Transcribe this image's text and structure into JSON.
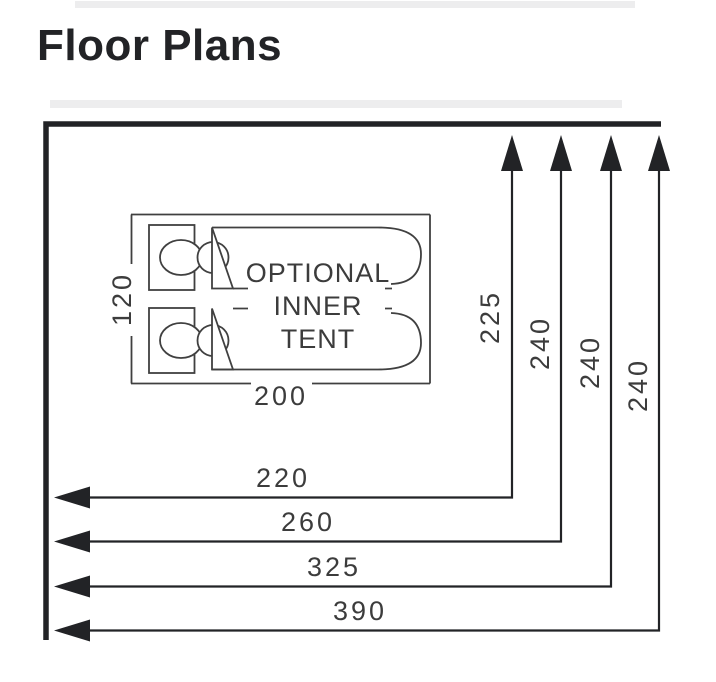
{
  "title": "Floor Plans",
  "colors": {
    "heavy": "#222326",
    "line": "#404040",
    "text": "#3c3c3c",
    "faint": "#ededee"
  },
  "inner_tent": {
    "label": [
      "OPTIONAL",
      "INNER",
      "TENT"
    ],
    "width_cm": "200",
    "depth_cm": "120"
  },
  "dimensions": {
    "depths": [
      "225",
      "240",
      "240",
      "240"
    ],
    "widths": [
      "220",
      "260",
      "325",
      "390"
    ]
  }
}
